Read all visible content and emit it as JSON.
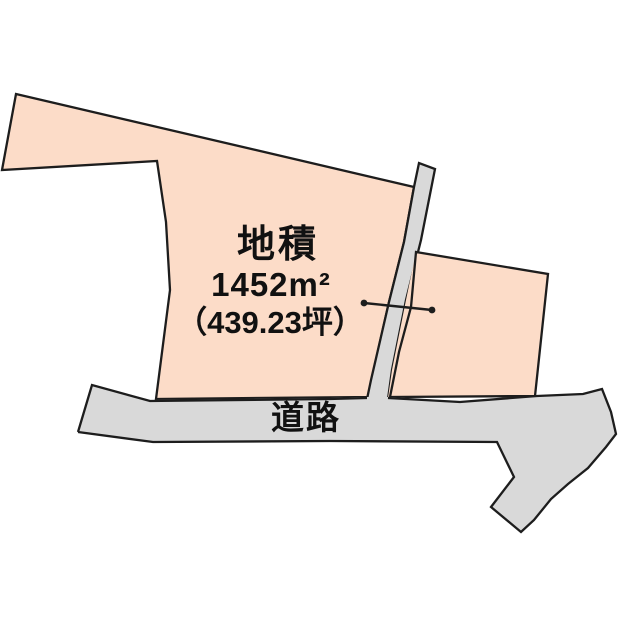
{
  "parcel": {
    "area_label": "地積",
    "area_sqm": "1452m²",
    "area_tsubo": "（439.23坪）"
  },
  "road": {
    "label": "道路"
  },
  "colors": {
    "parcel_fill": "#fcdcc8",
    "road_fill": "#d9d9d9",
    "outline": "#1d1d1d",
    "text": "#111111",
    "background": "#ffffff"
  }
}
